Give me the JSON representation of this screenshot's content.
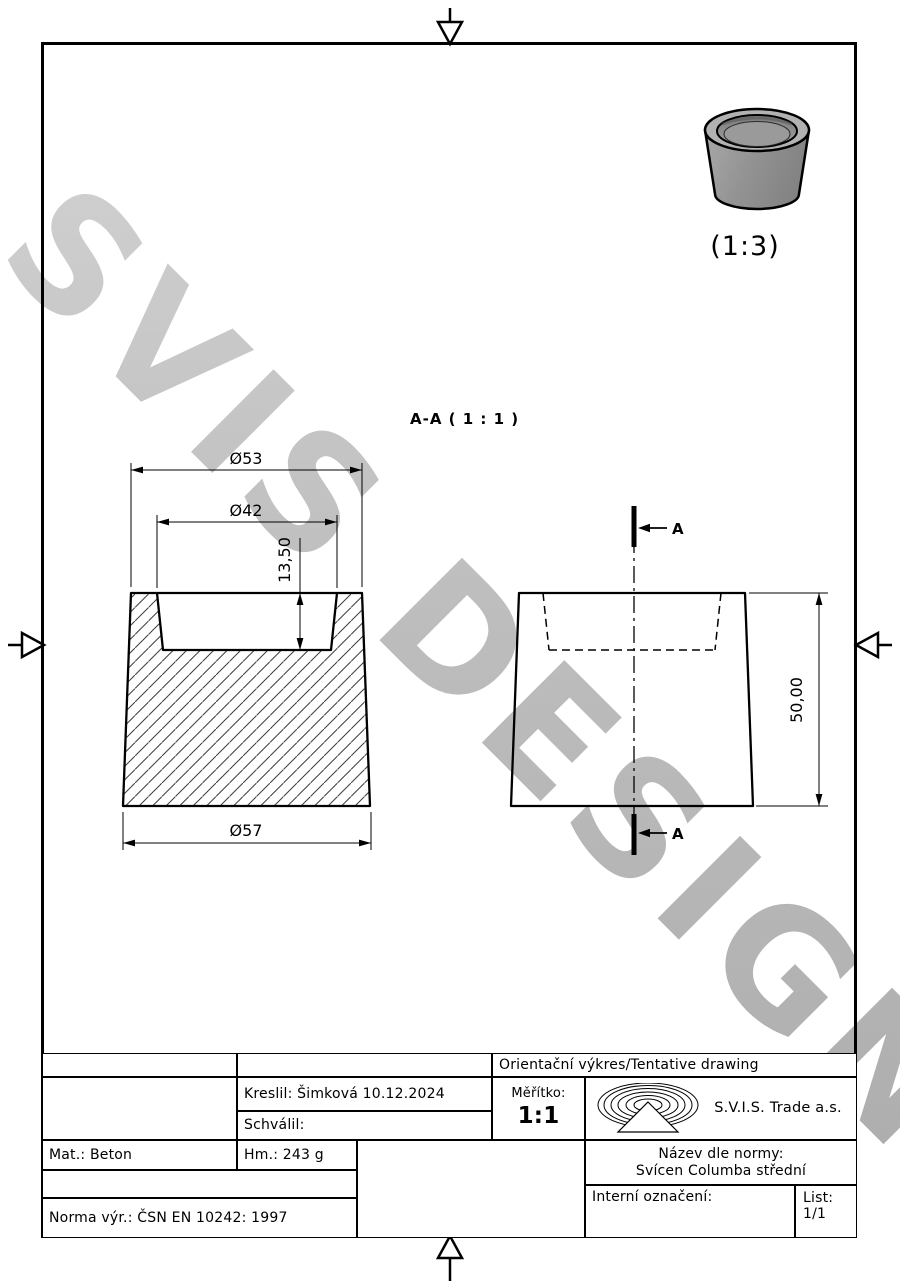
{
  "watermark": {
    "text": "SVIS DESIGN"
  },
  "iso_view": {
    "scale_label": "(1:3)"
  },
  "section_view": {
    "label": "A-A ( 1 : 1 )",
    "cut_arrow_top": "A",
    "cut_arrow_bottom": "A"
  },
  "dims": {
    "top_outer_dia": "Ø53",
    "pocket_dia": "Ø42",
    "pocket_depth": "13,50",
    "bottom_dia": "Ø57",
    "height": "50,00"
  },
  "title_block": {
    "drawing_type": "Orientační výkres/Tentative drawing",
    "drawn_by": "Kreslil: Šimková 10.12.2024",
    "approved_by": "Schválil:",
    "scale_label": "Měřítko:",
    "scale_value": "1:1",
    "company": "S.V.I.S. Trade a.s.",
    "material": "Mat.: Beton",
    "weight": "Hm.: 243 g",
    "norm": "Norma výr.: ČSN EN 10242: 1997",
    "name_label": "Název dle normy:",
    "name_value": "Svícen Columba střední",
    "internal_label": "Interní označení:",
    "sheet_label": "List:",
    "sheet_value": "1/1"
  },
  "colors": {
    "line": "#000000",
    "watermark": "#c2c2c2",
    "part_gray": "#8f8f8f"
  }
}
